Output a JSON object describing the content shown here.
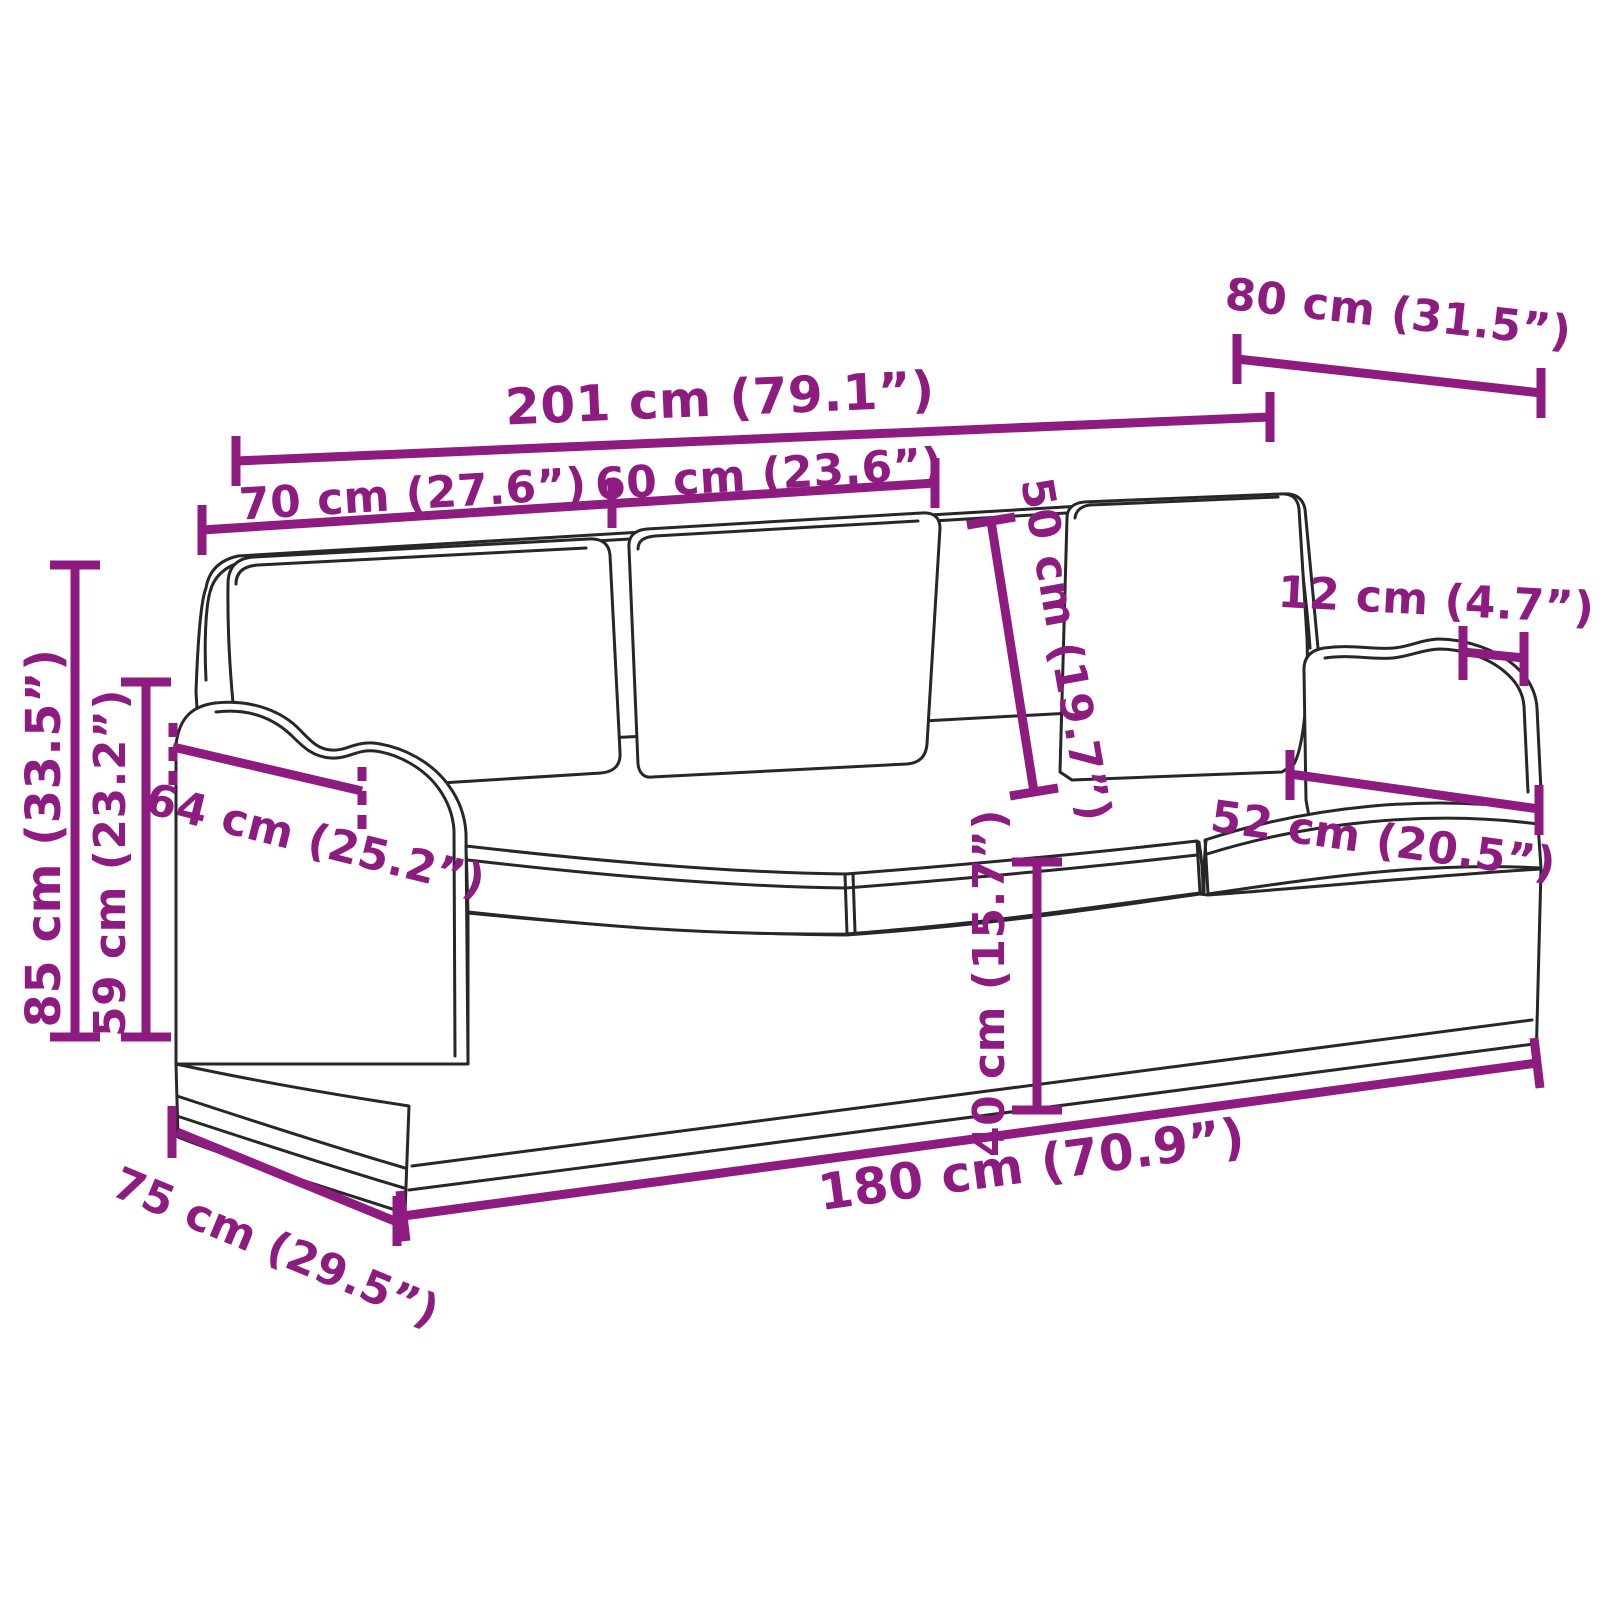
{
  "diagram": {
    "kind": "product dimension diagram",
    "subject": "3-seater sofa line drawing with measurement annotations",
    "accent_color": "#8e1b80",
    "line_color": "#272727",
    "background_color": "#ffffff",
    "unit_primary": "cm",
    "unit_secondary": "inches",
    "dimensions": {
      "overall_width": "201 cm (79.1”)",
      "seat_section_left_width": "70 cm (27.6”)",
      "seat_section_middle_width": "60 cm (23.6”)",
      "overall_depth": "80 cm (31.5”)",
      "back_cushion_height": "50 cm (19.7”)",
      "armrest_width": "12 cm (4.7”)",
      "seat_depth": "52 cm (20.5”)",
      "armrest_depth": "64 cm (25.2”)",
      "overall_height": "85 cm (33.5”)",
      "armrest_height": "59 cm (23.2”)",
      "seat_height": "40 cm (15.7”)",
      "inner_seat_width": "180 cm (70.9”)",
      "base_depth": "75 cm (29.5”)"
    }
  }
}
